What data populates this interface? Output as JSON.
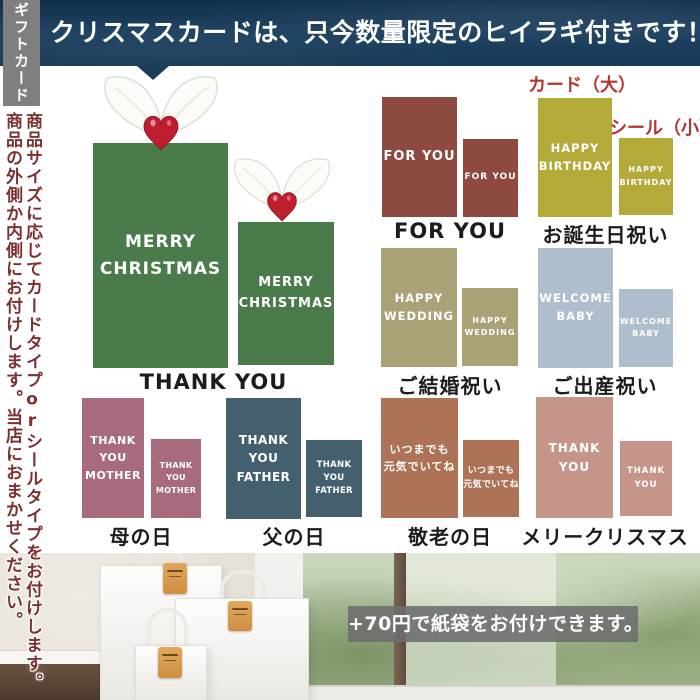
{
  "banner": {
    "text": "クリスマスカードは、只今数量限定のヒイラギ付きです！"
  },
  "sidebar": {
    "tab": "ギフトカード",
    "note_col1": "商品サイズに応じてカードタイプorシールタイプをお付けします。",
    "note_col2": "商品の外側か内側にお付けします。当店におまかせください。"
  },
  "size_labels": {
    "card_large": "カード（大）",
    "seal_small": "シール（小）"
  },
  "palette": {
    "banner_navy": "#1b3d5a",
    "accent_red": "#b23531",
    "note_red": "#7c3030",
    "tab_gray": "#7f7f7f",
    "overlay_gray": "#6f726f",
    "holly_berry_red": "#bf1e31"
  },
  "sections": [
    {
      "label": "THANK YOU",
      "color": "#4a7b4a",
      "large_lines": [
        "MERRY",
        "CHRISTMAS"
      ],
      "small_lines": [
        "MERRY",
        "CHRISTMAS"
      ]
    },
    {
      "label": "FOR YOU",
      "color": "#8e4a40",
      "large_lines": [
        "FOR YOU"
      ],
      "small_lines": [
        "FOR YOU"
      ]
    },
    {
      "label": "お誕生日祝い",
      "color": "#b4aa3a",
      "large_lines": [
        "HAPPY",
        "BIRTHDAY"
      ],
      "small_lines": [
        "HAPPY",
        "BIRTHDAY"
      ]
    },
    {
      "label": "ご結婚祝い",
      "color": "#a9a277",
      "large_lines": [
        "HAPPY",
        "WEDDING"
      ],
      "small_lines": [
        "HAPPY",
        "WEDDING"
      ]
    },
    {
      "label": "ご出産祝い",
      "color": "#afbecd",
      "large_lines": [
        "WELCOME",
        "BABY"
      ],
      "small_lines": [
        "WELCOME",
        "BABY"
      ]
    },
    {
      "label": "母の日",
      "color": "#a86b7c",
      "large_lines": [
        "THANK YOU",
        "MOTHER"
      ],
      "small_lines": [
        "THANK YOU",
        "MOTHER"
      ]
    },
    {
      "label": "父の日",
      "color": "#44606f",
      "large_lines": [
        "THANK YOU",
        "FATHER"
      ],
      "small_lines": [
        "THANK YOU",
        "FATHER"
      ]
    },
    {
      "label": "敬老の日",
      "color": "#ae7357",
      "large_lines": [
        "いつまでも",
        "元気でいてね"
      ],
      "small_lines": [
        "いつまでも",
        "元気でいてね"
      ]
    },
    {
      "label": "メリークリスマス",
      "color": "#c49588",
      "large_lines": [
        "THANK YOU"
      ],
      "small_lines": [
        "THANK YOU"
      ]
    }
  ],
  "footer": {
    "overlay_text": "+70円で紙袋をお付けできます。"
  }
}
